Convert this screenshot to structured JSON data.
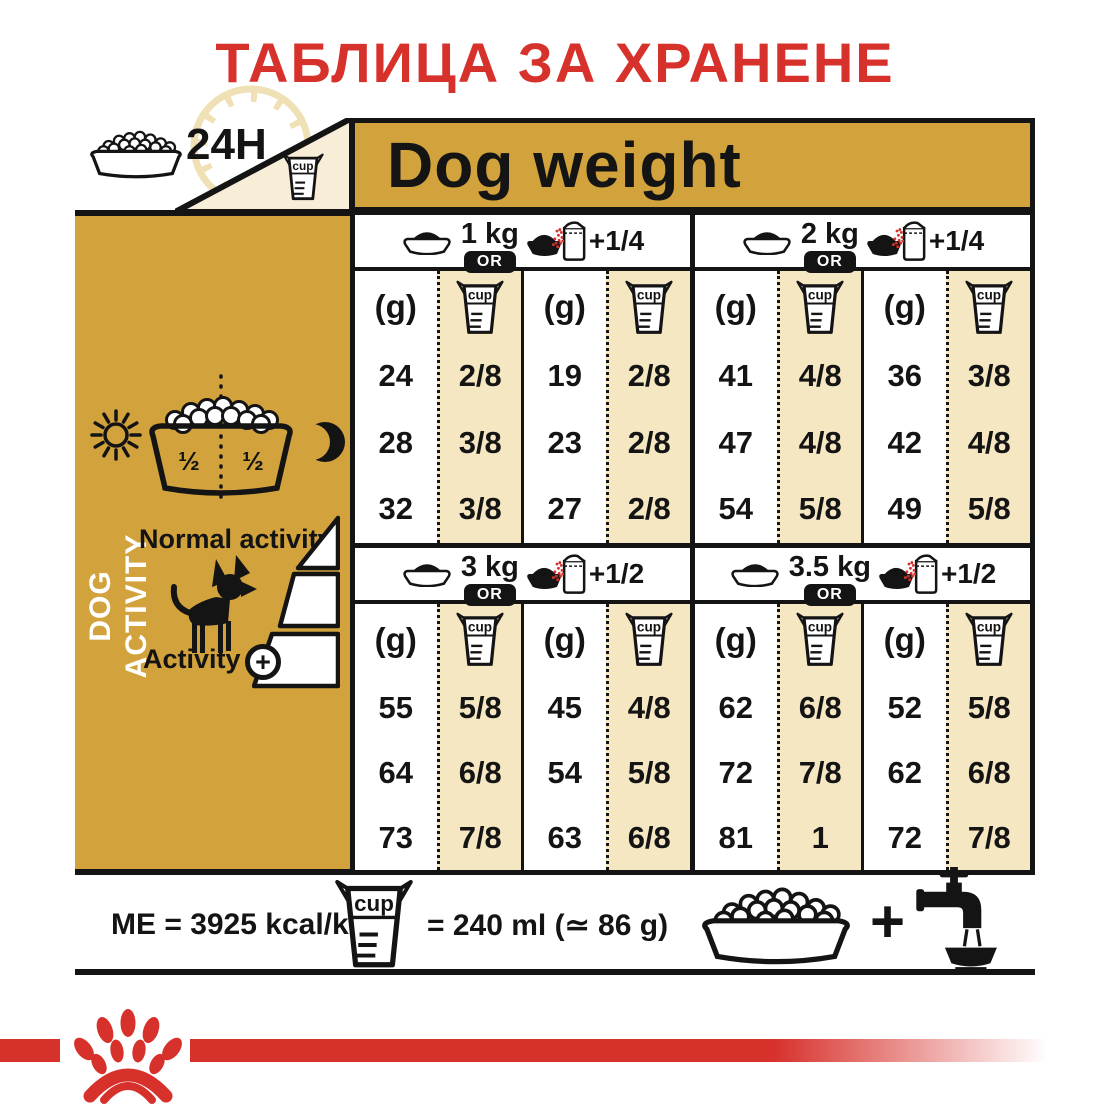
{
  "title": "ТАБЛИЦА ЗА ХРАНЕНЕ",
  "labels": {
    "hours": "24H",
    "cup": "cup",
    "plus": "+"
  },
  "header": {
    "dog_weight": "Dog weight"
  },
  "sidebar": {
    "vertical_label": "DOG ACTIVITY",
    "bowl_half": "½",
    "normal_activity": "Normal activity",
    "activity": "Activity"
  },
  "table": {
    "or_label": "OR",
    "gram_unit": "(g)",
    "sections": [
      {
        "weight": "1 kg",
        "extra": "+1/4",
        "groups": [
          {
            "g": [
              "24",
              "28",
              "32"
            ],
            "cup": [
              "2/8",
              "3/8",
              "3/8"
            ]
          },
          {
            "g": [
              "19",
              "23",
              "27"
            ],
            "cup": [
              "2/8",
              "2/8",
              "2/8"
            ]
          }
        ]
      },
      {
        "weight": "2 kg",
        "extra": "+1/4",
        "groups": [
          {
            "g": [
              "41",
              "47",
              "54"
            ],
            "cup": [
              "4/8",
              "4/8",
              "5/8"
            ]
          },
          {
            "g": [
              "36",
              "42",
              "49"
            ],
            "cup": [
              "3/8",
              "4/8",
              "5/8"
            ]
          }
        ]
      },
      {
        "weight": "3 kg",
        "extra": "+1/2",
        "groups": [
          {
            "g": [
              "55",
              "64",
              "73"
            ],
            "cup": [
              "5/8",
              "6/8",
              "7/8"
            ]
          },
          {
            "g": [
              "45",
              "54",
              "63"
            ],
            "cup": [
              "4/8",
              "5/8",
              "6/8"
            ]
          }
        ]
      },
      {
        "weight": "3.5 kg",
        "extra": "+1/2",
        "groups": [
          {
            "g": [
              "62",
              "72",
              "81"
            ],
            "cup": [
              "6/8",
              "7/8",
              "1"
            ]
          },
          {
            "g": [
              "52",
              "62",
              "72"
            ],
            "cup": [
              "5/8",
              "6/8",
              "7/8"
            ]
          }
        ]
      }
    ]
  },
  "footer": {
    "me_label": "ME = 3925 kcal/kg",
    "cup_equiv": "= 240 ml (≃ 86 g)"
  },
  "colors": {
    "gold": "#D2A23C",
    "tan": "#F6E7C3",
    "cream": "#F8EDD7",
    "red": "#D7312C",
    "ink": "#141414"
  },
  "icons": [
    "kibble-bowl-icon",
    "clock-24h-dial-icon",
    "measuring-cup-icon",
    "plain-bowl-icon",
    "kibble-bag-bowl-icon",
    "sun-icon",
    "moon-icon",
    "dog-silhouette-icon",
    "activity-plus-icon",
    "water-tap-icon",
    "plus-icon",
    "paw-logo-icon"
  ],
  "chart_data": {
    "type": "table",
    "title": "ТАБЛИЦА ЗА ХРАНЕНЕ",
    "column_group_header": "Dog weight",
    "row_axis": "DOG ACTIVITY (Normal activity → Activity +)",
    "units": [
      "g",
      "cup"
    ],
    "sections": [
      {
        "dog_weight_kg": 1,
        "dry_plus_wet": "+1/4",
        "dry_only_g": [
          24,
          28,
          32
        ],
        "dry_only_cup": [
          "2/8",
          "3/8",
          "3/8"
        ],
        "with_wet_g": [
          19,
          23,
          27
        ],
        "with_wet_cup": [
          "2/8",
          "2/8",
          "2/8"
        ]
      },
      {
        "dog_weight_kg": 2,
        "dry_plus_wet": "+1/4",
        "dry_only_g": [
          41,
          47,
          54
        ],
        "dry_only_cup": [
          "4/8",
          "4/8",
          "5/8"
        ],
        "with_wet_g": [
          36,
          42,
          49
        ],
        "with_wet_cup": [
          "3/8",
          "4/8",
          "5/8"
        ]
      },
      {
        "dog_weight_kg": 3,
        "dry_plus_wet": "+1/2",
        "dry_only_g": [
          55,
          64,
          73
        ],
        "dry_only_cup": [
          "5/8",
          "6/8",
          "7/8"
        ],
        "with_wet_g": [
          45,
          54,
          63
        ],
        "with_wet_cup": [
          "4/8",
          "5/8",
          "6/8"
        ]
      },
      {
        "dog_weight_kg": 3.5,
        "dry_plus_wet": "+1/2",
        "dry_only_g": [
          62,
          72,
          81
        ],
        "dry_only_cup": [
          "6/8",
          "7/8",
          "1"
        ],
        "with_wet_g": [
          52,
          62,
          72
        ],
        "with_wet_cup": [
          "5/8",
          "6/8",
          "7/8"
        ]
      }
    ],
    "footnotes": {
      "me_kcal_per_kg": 3925,
      "cup_ml": 240,
      "cup_g": 86
    }
  }
}
